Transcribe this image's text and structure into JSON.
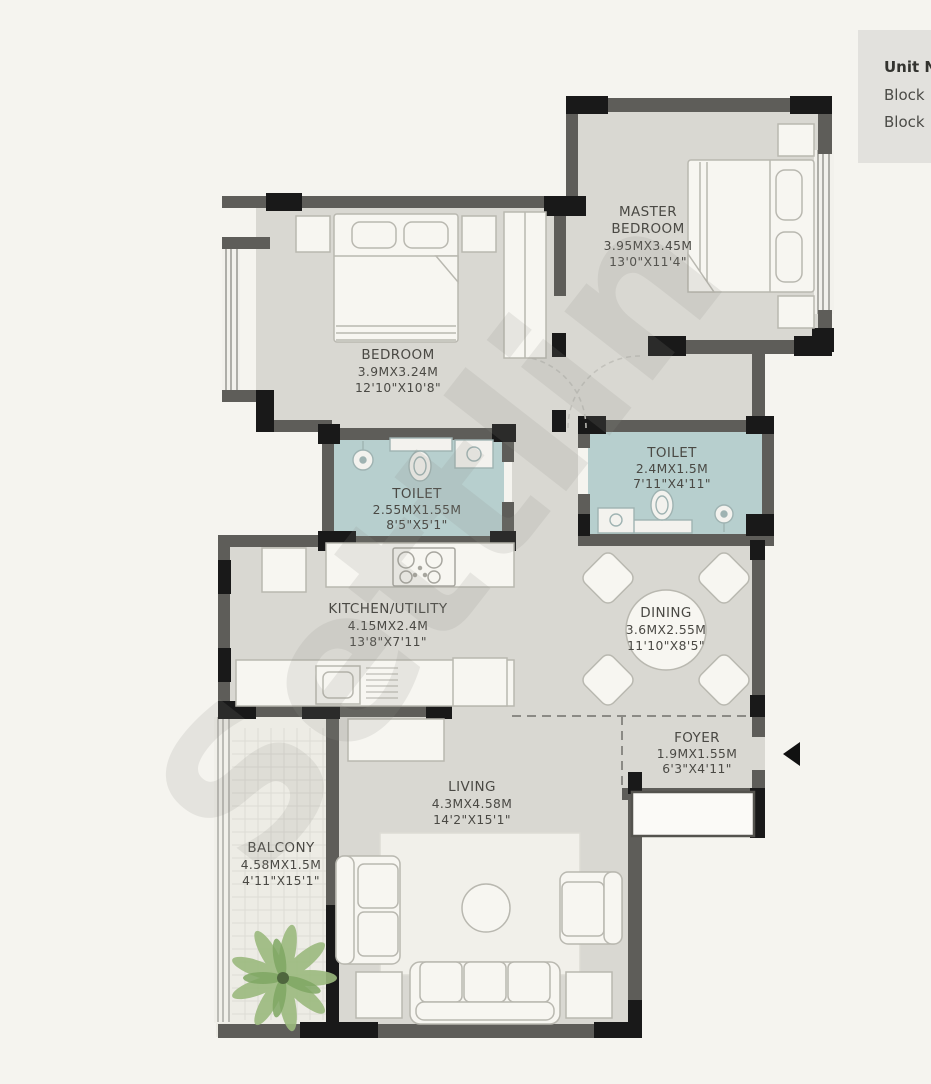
{
  "info_box": {
    "title": "Unit N",
    "lines": [
      "Block",
      "Block"
    ]
  },
  "watermark": {
    "text": "Settlin"
  },
  "colors": {
    "background": "#f5f4ef",
    "floor": "#d9d8d2",
    "toilet_floor": "#b7cfce",
    "balcony_floor": "#edece5",
    "wall": "#5e5d59",
    "wall_dark": "#191919",
    "furniture": "#f7f6f1",
    "furniture_stroke": "#b9b8b0",
    "label_text": "#4a4944",
    "plant_green": "#8fb473",
    "info_box_bg": "#e2e1dd"
  },
  "rooms": {
    "master_bedroom": {
      "name_line1": "MASTER",
      "name_line2": "BEDROOM",
      "metric": "3.95MX3.45M",
      "imperial": "13'0\"X11'4\""
    },
    "bedroom": {
      "name": "BEDROOM",
      "metric": "3.9MX3.24M",
      "imperial": "12'10\"X10'8\""
    },
    "toilet_1": {
      "name": "TOILET",
      "metric": "2.55MX1.55M",
      "imperial": "8'5\"X5'1\""
    },
    "toilet_2": {
      "name": "TOILET",
      "metric": "2.4MX1.5M",
      "imperial": "7'11\"X4'11\""
    },
    "kitchen": {
      "name": "KITCHEN/UTILITY",
      "metric": "4.15MX2.4M",
      "imperial": "13'8\"X7'11\""
    },
    "dining": {
      "name": "DINING",
      "metric": "3.6MX2.55M",
      "imperial": "11'10\"X8'5\""
    },
    "foyer": {
      "name": "FOYER",
      "metric": "1.9MX1.55M",
      "imperial": "6'3\"X4'11\""
    },
    "living": {
      "name": "LIVING",
      "metric": "4.3MX4.58M",
      "imperial": "14'2\"X15'1\""
    },
    "balcony": {
      "name": "BALCONY",
      "metric": "4.58MX1.5M",
      "imperial": "4'11\"X15'1\""
    }
  }
}
